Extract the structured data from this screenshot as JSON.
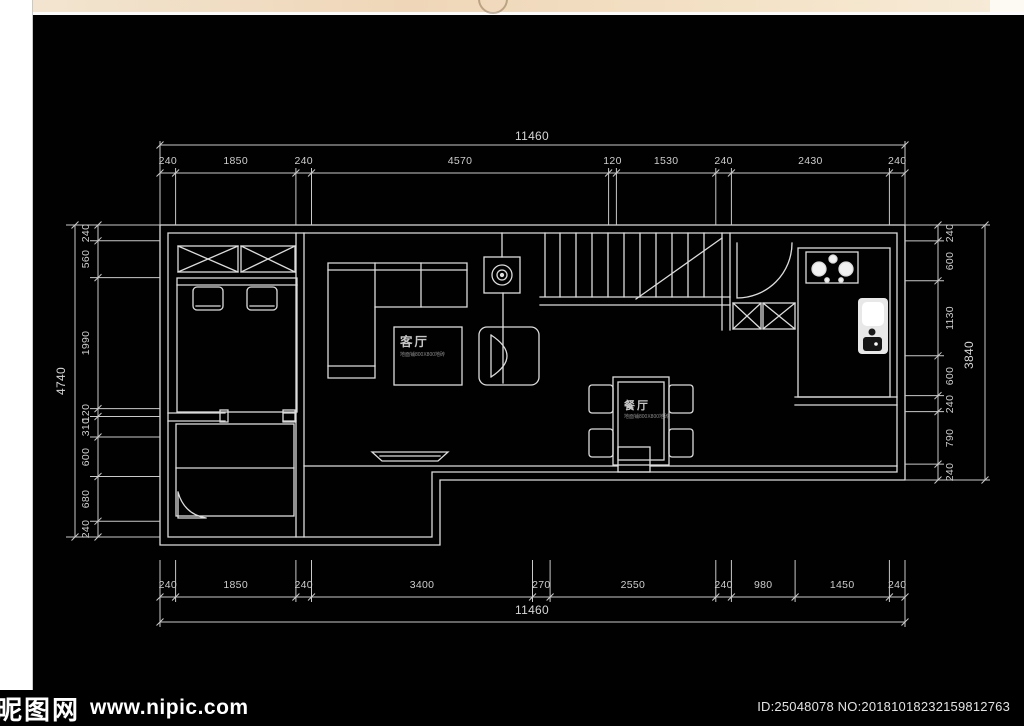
{
  "dimensions": {
    "top_total": "11460",
    "top_segments": [
      "240",
      "1850",
      "240",
      "4570",
      "120",
      "1530",
      "240",
      "2430",
      "240"
    ],
    "left_total": "4740",
    "left_segments": [
      "240",
      "560",
      "1990",
      "120",
      "310",
      "600",
      "680",
      "240"
    ],
    "right_total": "3840",
    "right_segments": [
      "240",
      "600",
      "1130",
      "600",
      "240",
      "790",
      "240"
    ],
    "bottom_total": "11460",
    "bottom_segments": [
      "240",
      "1850",
      "240",
      "3400",
      "270",
      "2550",
      "240",
      "980",
      "1450",
      "240"
    ]
  },
  "rooms": {
    "living": {
      "name": "客厅",
      "note": "地面铺800X800地砖"
    },
    "dining": {
      "name": "餐厅",
      "note": "地面铺800X800地砖"
    }
  },
  "footer": {
    "site_name": "昵图网",
    "site_url": "www.nipic.com",
    "image_id": "ID:25048078 NO:20181018232159812763"
  }
}
